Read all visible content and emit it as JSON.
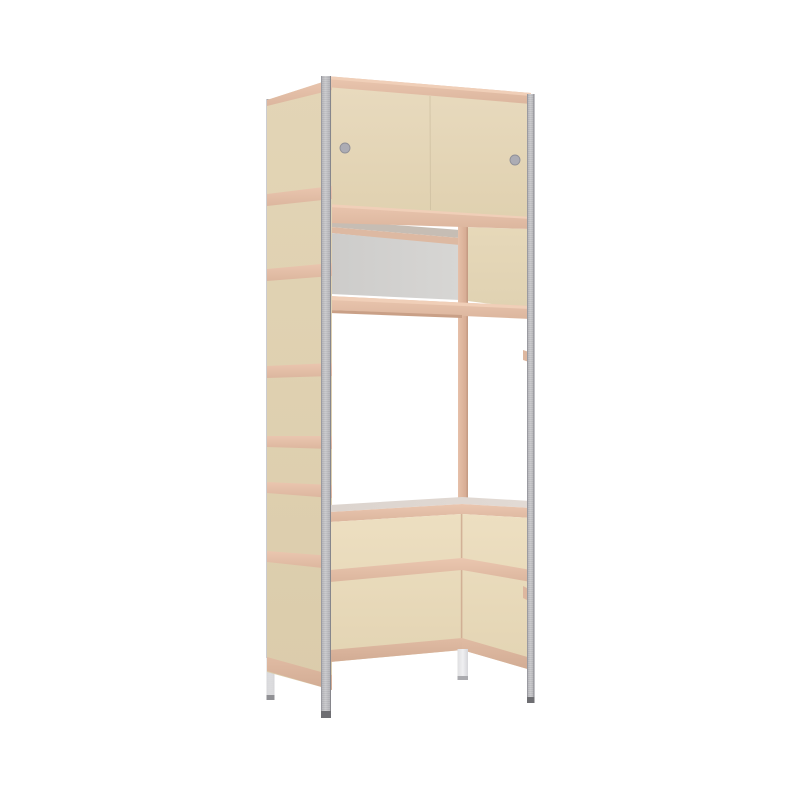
{
  "scene": {
    "label": "furniture-render",
    "object": "tall storage unit with sliding-door top cabinet, open drawer niche, and integrated desk on metal frame posts",
    "background": "#FFFFFF"
  },
  "palette": {
    "background": "#FFFFFF",
    "door_top": "#E8DABE",
    "door_bottom": "#E0D1B0",
    "side_top": "#E3D5B6",
    "side_bottom": "#DBCCAB",
    "niche_top": "#E6D8B9",
    "niche_bottom": "#E0D2B2",
    "below_top": "#EDDFC1",
    "below_bottom": "#E3D4B3",
    "band_top": "#EAC6AF",
    "band_bottom": "#DCB69E",
    "band_light": "#F0CFB8",
    "band_dark_top": "#E0BBA3",
    "band_dark_bottom": "#D2AC94",
    "band_underline": "#C9A087",
    "wedge_grey": "#C6BDB4",
    "inner_strip": "#DDB9A2",
    "box_left": "#CDCCCA",
    "box_right": "#D7D6D4",
    "desk_left": "#DCD4CE",
    "desk_right": "#E2DAD4",
    "tan_post_light": "#E6C0A9",
    "tan_post_dark": "#D3A88F",
    "tan_post_edge": "#C69C84",
    "corner_line": "#C89E86",
    "metal_mid": "#B7B7BB",
    "metal_hl": "#C5C5C9",
    "metal_edge_l": "#9A9AA0",
    "metal_edge_r": "#86868C",
    "post_tip": "#6E6E72",
    "leg_white_l": "#DFDFE1",
    "leg_white_m": "#EFEFF1",
    "leg_white_r": "#D6D6DA",
    "leg_tip": "#ABABAF",
    "backleg_light": "#DEDEE0",
    "backleg_tip": "#909094",
    "seam": "#CBBC9E",
    "hole_fill": "#ACACB4",
    "hole_rim": "#8F8F97",
    "bracket_tan": "#DDB79F"
  },
  "parts": [
    "frame-post-back-left",
    "frame-post-front-left",
    "frame-post-front-right",
    "back-corner-post",
    "cabinet-doors",
    "door-handle-hole-left",
    "door-handle-hole-right",
    "drawer-box",
    "shelf-upper",
    "shelf-lower",
    "side-panel",
    "desk-surface",
    "modesty-panel-left",
    "modesty-panel-right",
    "desk-leg"
  ]
}
